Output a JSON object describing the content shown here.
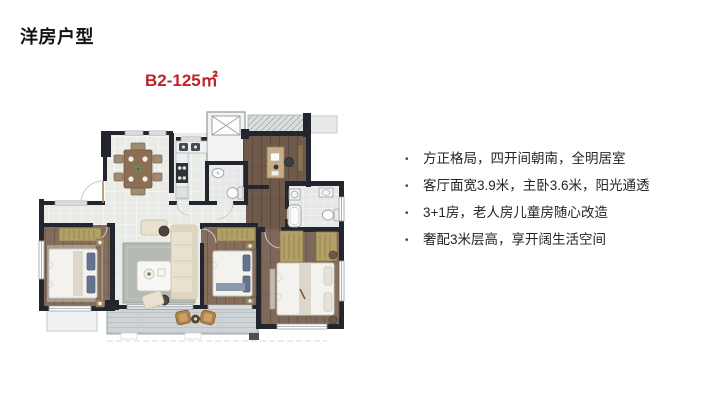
{
  "slide": {
    "title": "洋房户型"
  },
  "floor_plan": {
    "label": "B2-125㎡",
    "label_color": "#bf2327"
  },
  "features": {
    "bullet": "•",
    "items": [
      "方正格局，四开间朝南，全明居室",
      "客厅面宽3.9米，主卧3.6米，阳光通透",
      "3+1房，老人房儿童房随心改造",
      "奢配3米层高，享开阔生活空间"
    ]
  },
  "colors": {
    "accent_red": "#bf2327",
    "wall": "#23262e",
    "tile_floor": "#e9ebe7",
    "wood_floor": "#846e5b"
  }
}
